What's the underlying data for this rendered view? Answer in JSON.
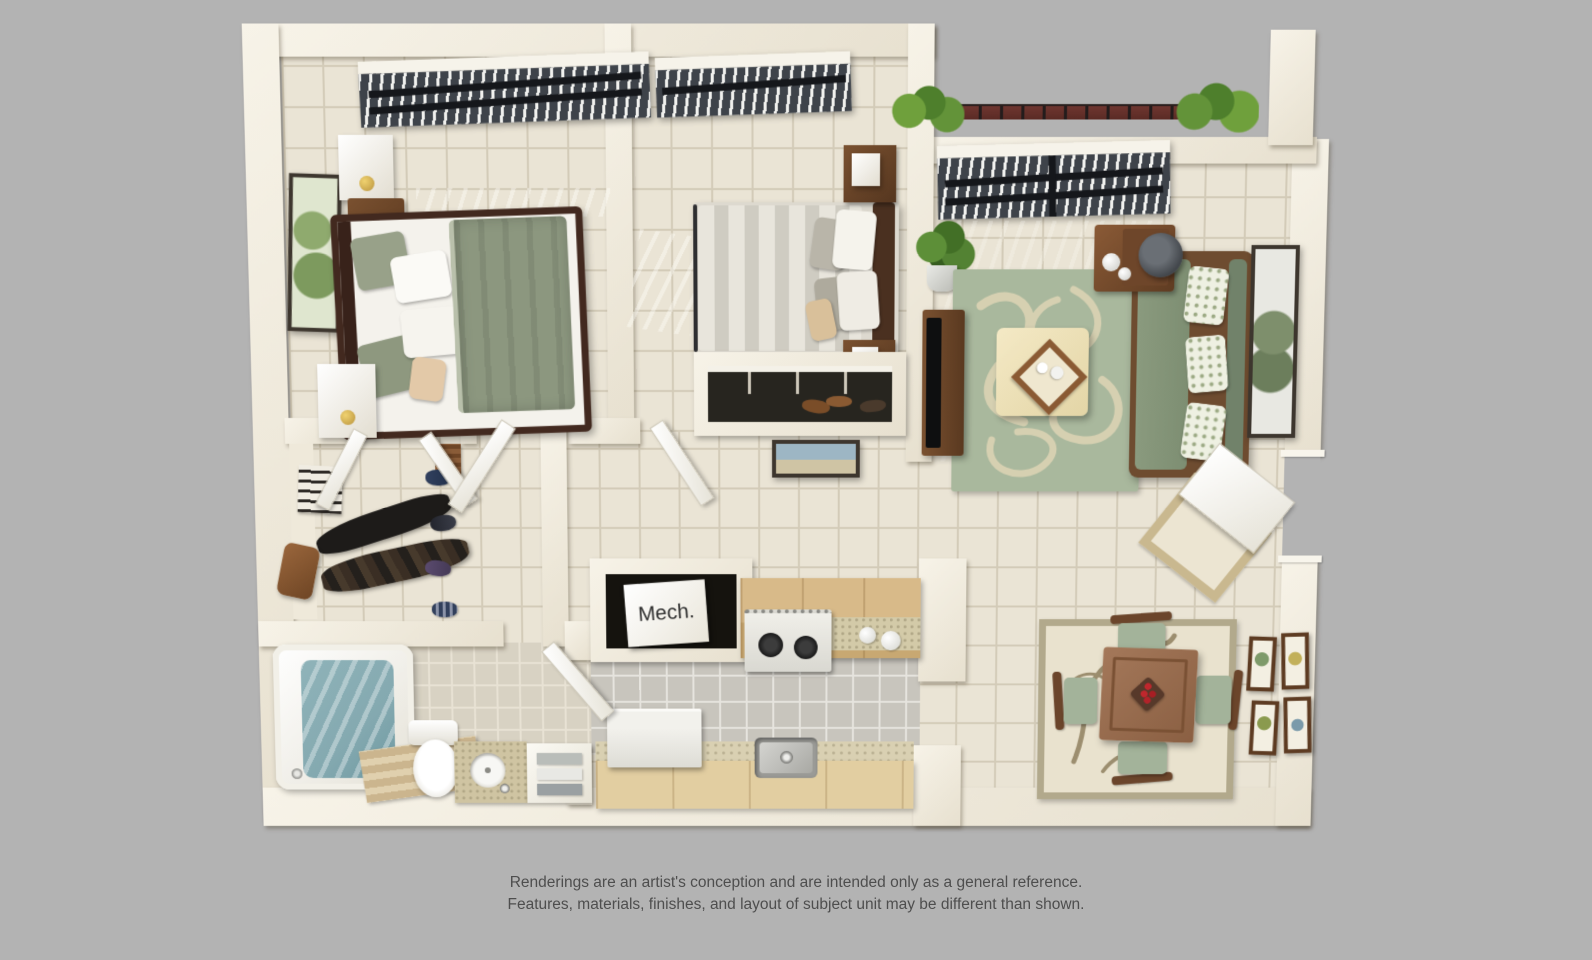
{
  "disclaimer": {
    "line1": "Renderings are an artist's conception and are intended only as a general reference.",
    "line2": "Features, materials, finishes, and layout of subject unit may be different than shown."
  },
  "floor_plan": {
    "mech_label": "Mech."
  },
  "colors": {
    "background": "#b3b3b3",
    "wall_light": "#f7f3e8",
    "wall_dark": "#e7e0cf",
    "floor_tile": "#eae4d5",
    "grout": "#d3cbb8",
    "kitchen_floor": "#c8c5bd",
    "kitchen_grout": "#e6e4de",
    "bath_floor": "#d8d2c3",
    "sage": "#8c977f",
    "sofa_green": "#84957a",
    "rug_green": "#a9b89d",
    "rug_cream": "#dbd3b4",
    "wood_dark": "#42291f",
    "wood_medium": "#8a5c3b",
    "wood_light": "#d8ba89",
    "counter_beige": "#e2cea1",
    "water_teal": "#84a9b0",
    "railing": "#6f3630",
    "plant": "#54802f",
    "text": "#4e4e4e"
  }
}
